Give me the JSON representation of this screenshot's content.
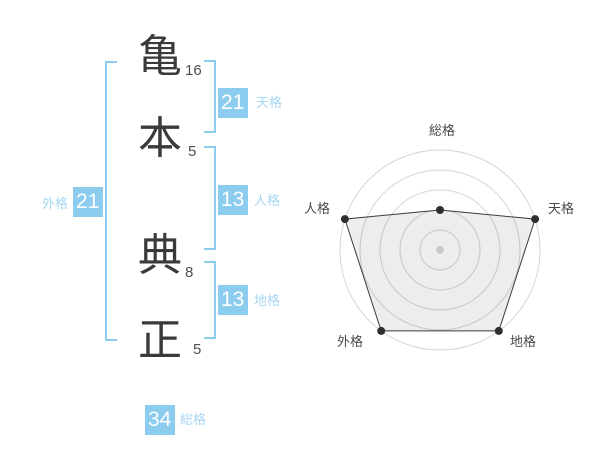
{
  "name_panel": {
    "characters": [
      {
        "char": "亀",
        "strokes": "16"
      },
      {
        "char": "本",
        "strokes": "5"
      },
      {
        "char": "典",
        "strokes": "8"
      },
      {
        "char": "正",
        "strokes": "5"
      }
    ],
    "badges": {
      "tenkaku": {
        "value": "21",
        "label": "天格"
      },
      "jinkaku": {
        "value": "13",
        "label": "人格"
      },
      "chikaku": {
        "value": "13",
        "label": "地格"
      },
      "gaikaku": {
        "value": "21",
        "label": "外格"
      },
      "soukaku": {
        "value": "34",
        "label": "総格"
      }
    }
  },
  "colors": {
    "accent_blue": "#8CCCEF",
    "label_blue": "#A6D7F3",
    "kanji_dark": "#3A3A3A",
    "stroke_gray": "#4F4F4F",
    "chart_label": "#4A4A4A",
    "ring_gray": "#D6D6D6",
    "polygon_stroke": "#3A3A3A",
    "polygon_fill": "rgba(0,0,0,0.07)",
    "dot_dark": "#2E2E2E",
    "center_dot": "#C9C9C9"
  },
  "chart_data": {
    "type": "radar",
    "title": "",
    "axes": [
      "総格",
      "天格",
      "地格",
      "外格",
      "人格"
    ],
    "values": [
      2,
      5,
      5,
      5,
      5
    ],
    "max": 5,
    "rings": 5,
    "grid": "concentric-circles",
    "legend_position": "none"
  }
}
